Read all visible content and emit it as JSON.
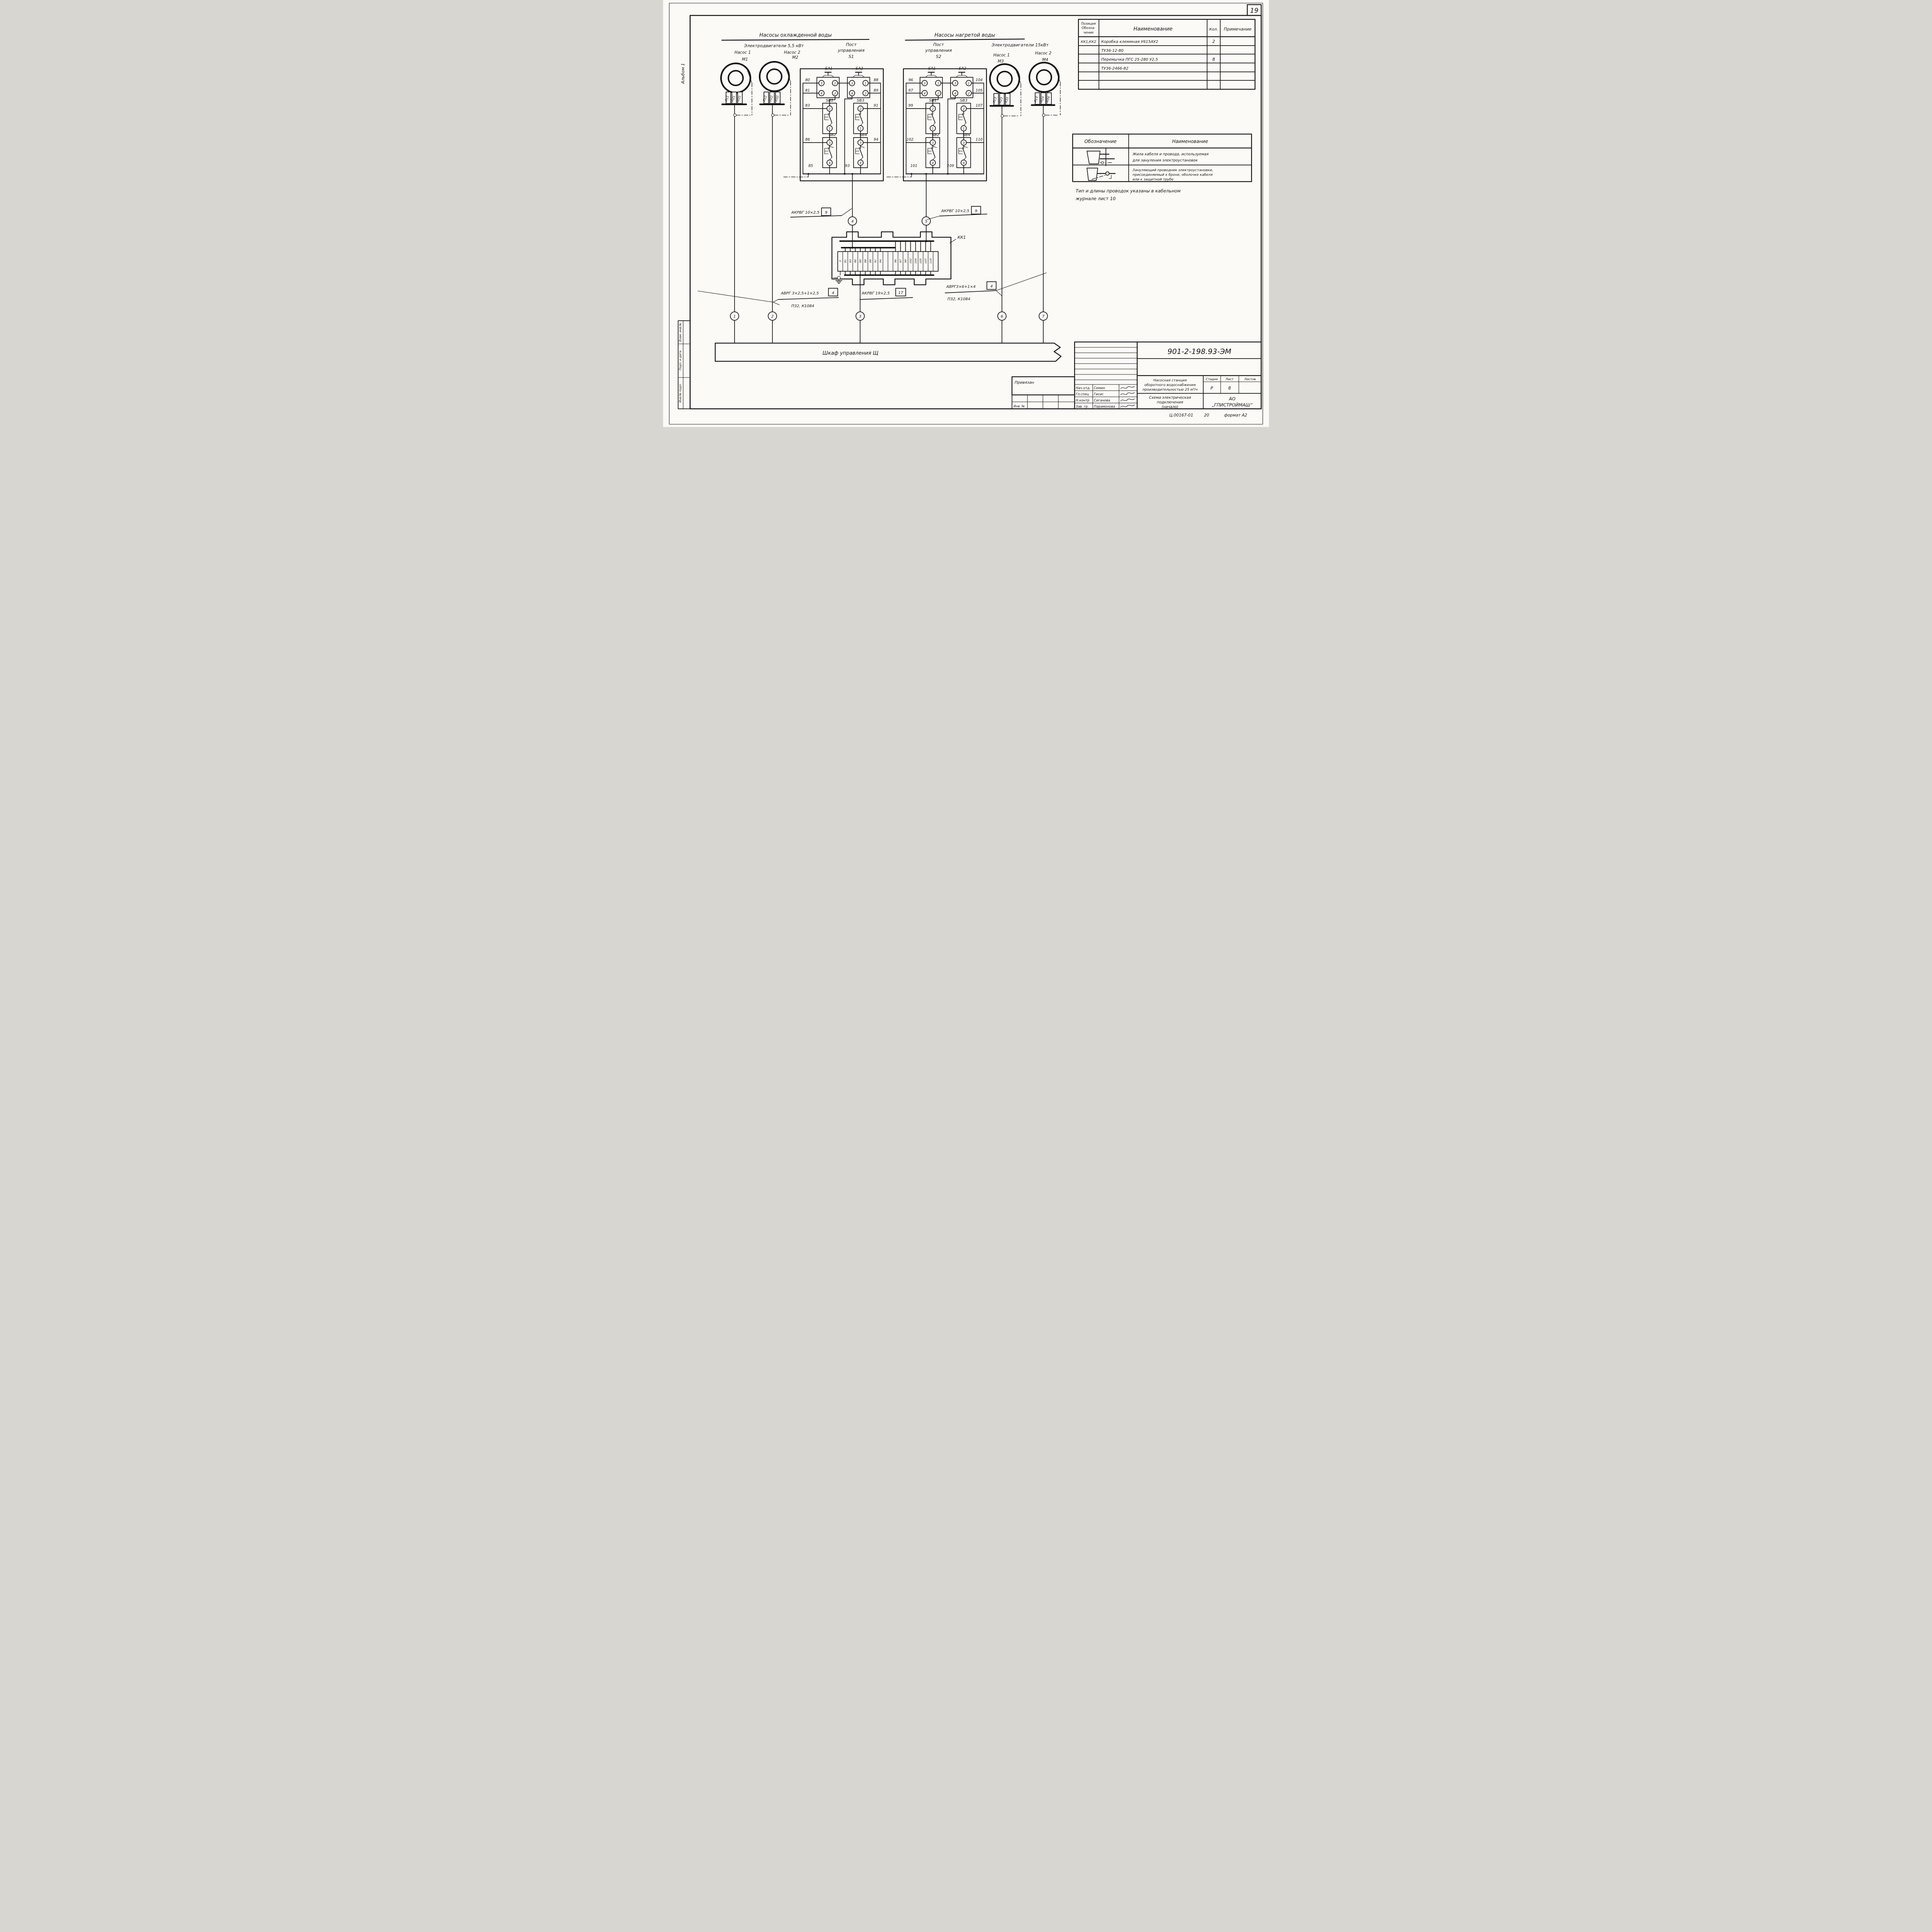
{
  "sheet": {
    "corner_number": "19",
    "album": "Альбом 1",
    "footer_code": "Ц.00167-01",
    "footer_num": "20",
    "footer_format": "формат А2"
  },
  "margin": {
    "stamp1": "Взам. инв.№",
    "stamp2": "Подп. и дата",
    "stamp3": "Инв.№ подл."
  },
  "parts_table": {
    "h_pos1": "Позиция",
    "h_pos2": "Обозна-",
    "h_pos3": "чение",
    "h_name": "Наименование",
    "h_qty": "Кол.",
    "h_note": "Примечание",
    "r1_pos": "КК1,КК2",
    "r1_name": "Коробка клеммная У615АУ2",
    "r1_qty": "2",
    "r2_name": "ТУ36-12-80",
    "r3_name": "Перемычка ПГС 25-280 У2,5",
    "r3_qty": "8",
    "r4_name": "ТУ36-2466-82"
  },
  "legend": {
    "h_sym": "Обозначение",
    "h_name": "Наименование",
    "r1_l1": "Жила кабеля и провода, используемая",
    "r1_l2": "для зануления электроустановок",
    "r2_l1": "Зануляющий проводник электроустановки,",
    "r2_l2": "присоединяемый к броне, оболочке кабеля",
    "r2_l3": "или к защитной трубе"
  },
  "note": {
    "l1": "Тип и длины проводок указаны в кабельном",
    "l2": "журнале  лист 10"
  },
  "left_group": {
    "title": "Насосы  охлажденной  воды",
    "motors": "Электродвигатели 5,5 кВт",
    "pump1": "Насос 1",
    "pump2": "Насос 2",
    "m1": "М1",
    "m2": "М2",
    "post1": "Пост",
    "post2": "управления",
    "post3": "S1"
  },
  "right_group": {
    "title": "Насосы  нагретой  воды",
    "motors": "Электродвигатели 15кВт",
    "pump1": "Насос 1",
    "pump2": "Насос 2",
    "m3": "М3",
    "m4": "М4",
    "post1": "Пост",
    "post2": "управления",
    "post3": "S2"
  },
  "motor_cables": {
    "m1": [
      "Л11",
      "Л21",
      "Л31"
    ],
    "m2": [
      "Л12",
      "Л22",
      "Л32"
    ],
    "m3": [
      "Л13",
      "Л23",
      "Л33"
    ],
    "m4": [
      "Л14",
      "Л24",
      "Л34"
    ]
  },
  "contacts": [
    "1",
    "2",
    "3",
    "4"
  ],
  "posts": {
    "s1": {
      "sa1": "SA1",
      "sa2": "SA2",
      "sb1": "SB1",
      "sb2": "SB2",
      "sb3": "SB3",
      "sb4": "SB4",
      "w80": "80",
      "w81": "81",
      "w83": "83",
      "w86": "86",
      "w85": "85",
      "w88": "88",
      "w89": "89",
      "w91": "91",
      "w94": "94",
      "w93": "93"
    },
    "s2": {
      "sa1": "SA1",
      "sa2": "SA2",
      "sb1": "SB1",
      "sb2": "SB2",
      "sb3": "SB3",
      "sb4": "SB4",
      "w96": "96",
      "w97": "97",
      "w99": "99",
      "w102": "102",
      "w101": "101",
      "w104": "104",
      "w105": "105",
      "w107": "107",
      "w110": "110",
      "w109": "109"
    }
  },
  "kk1": {
    "tag": "КК1",
    "t": [
      "3",
      "81",
      "83",
      "86",
      "80",
      "88",
      "89",
      "91",
      "94",
      "",
      "",
      "96",
      "97",
      "99",
      "102",
      "104",
      "105",
      "107",
      "110",
      ""
    ]
  },
  "circles": [
    "1",
    "2",
    "3",
    "4",
    "5",
    "6",
    "7"
  ],
  "cables": {
    "akrvg10l": {
      "text": "АКРВГ 10×2,5",
      "ref": "9"
    },
    "akrvg10r": {
      "text": "АКРВГ 10×2,5",
      "ref": "9"
    },
    "avrg25": {
      "text": "АВРГ 3×2,5+1×2,5",
      "ref": "4",
      "route": "П32,  К1084"
    },
    "akrvg19": {
      "text": "АКРВГ 19×2,5",
      "ref": "17"
    },
    "avrg64": {
      "text": "АВРГ3×6+1×4",
      "ref": "4",
      "route": "П32,  К1084"
    }
  },
  "cabinet": "Шкаф    управления Щ",
  "tb": {
    "doc": "901-2-198.93-ЭМ",
    "binding": "Привязан",
    "inv": "Инв. №",
    "p1": "Насосная станция",
    "p2": "оборотного водоснабжения",
    "p3": "производительностью 25 м³/ч",
    "t1": "Схема электрическая",
    "t2": "подключения",
    "t3": "(начало)",
    "c1": "АО",
    "c2": "„ГПИСТРОЙМАШ“",
    "stage_l": "Стадия",
    "sheet_l": "Лист",
    "sheets_l": "Листов",
    "stage": "Р",
    "sheet": "8",
    "s1r": "Нач.отд.",
    "s1n": "Семин",
    "s2r": "Гл.спец",
    "s2n": "Гисис",
    "s3r": "Н.контр",
    "s3n": "Сиганова",
    "s4r": "Зав. гр.",
    "s4n": "Парамонова"
  }
}
